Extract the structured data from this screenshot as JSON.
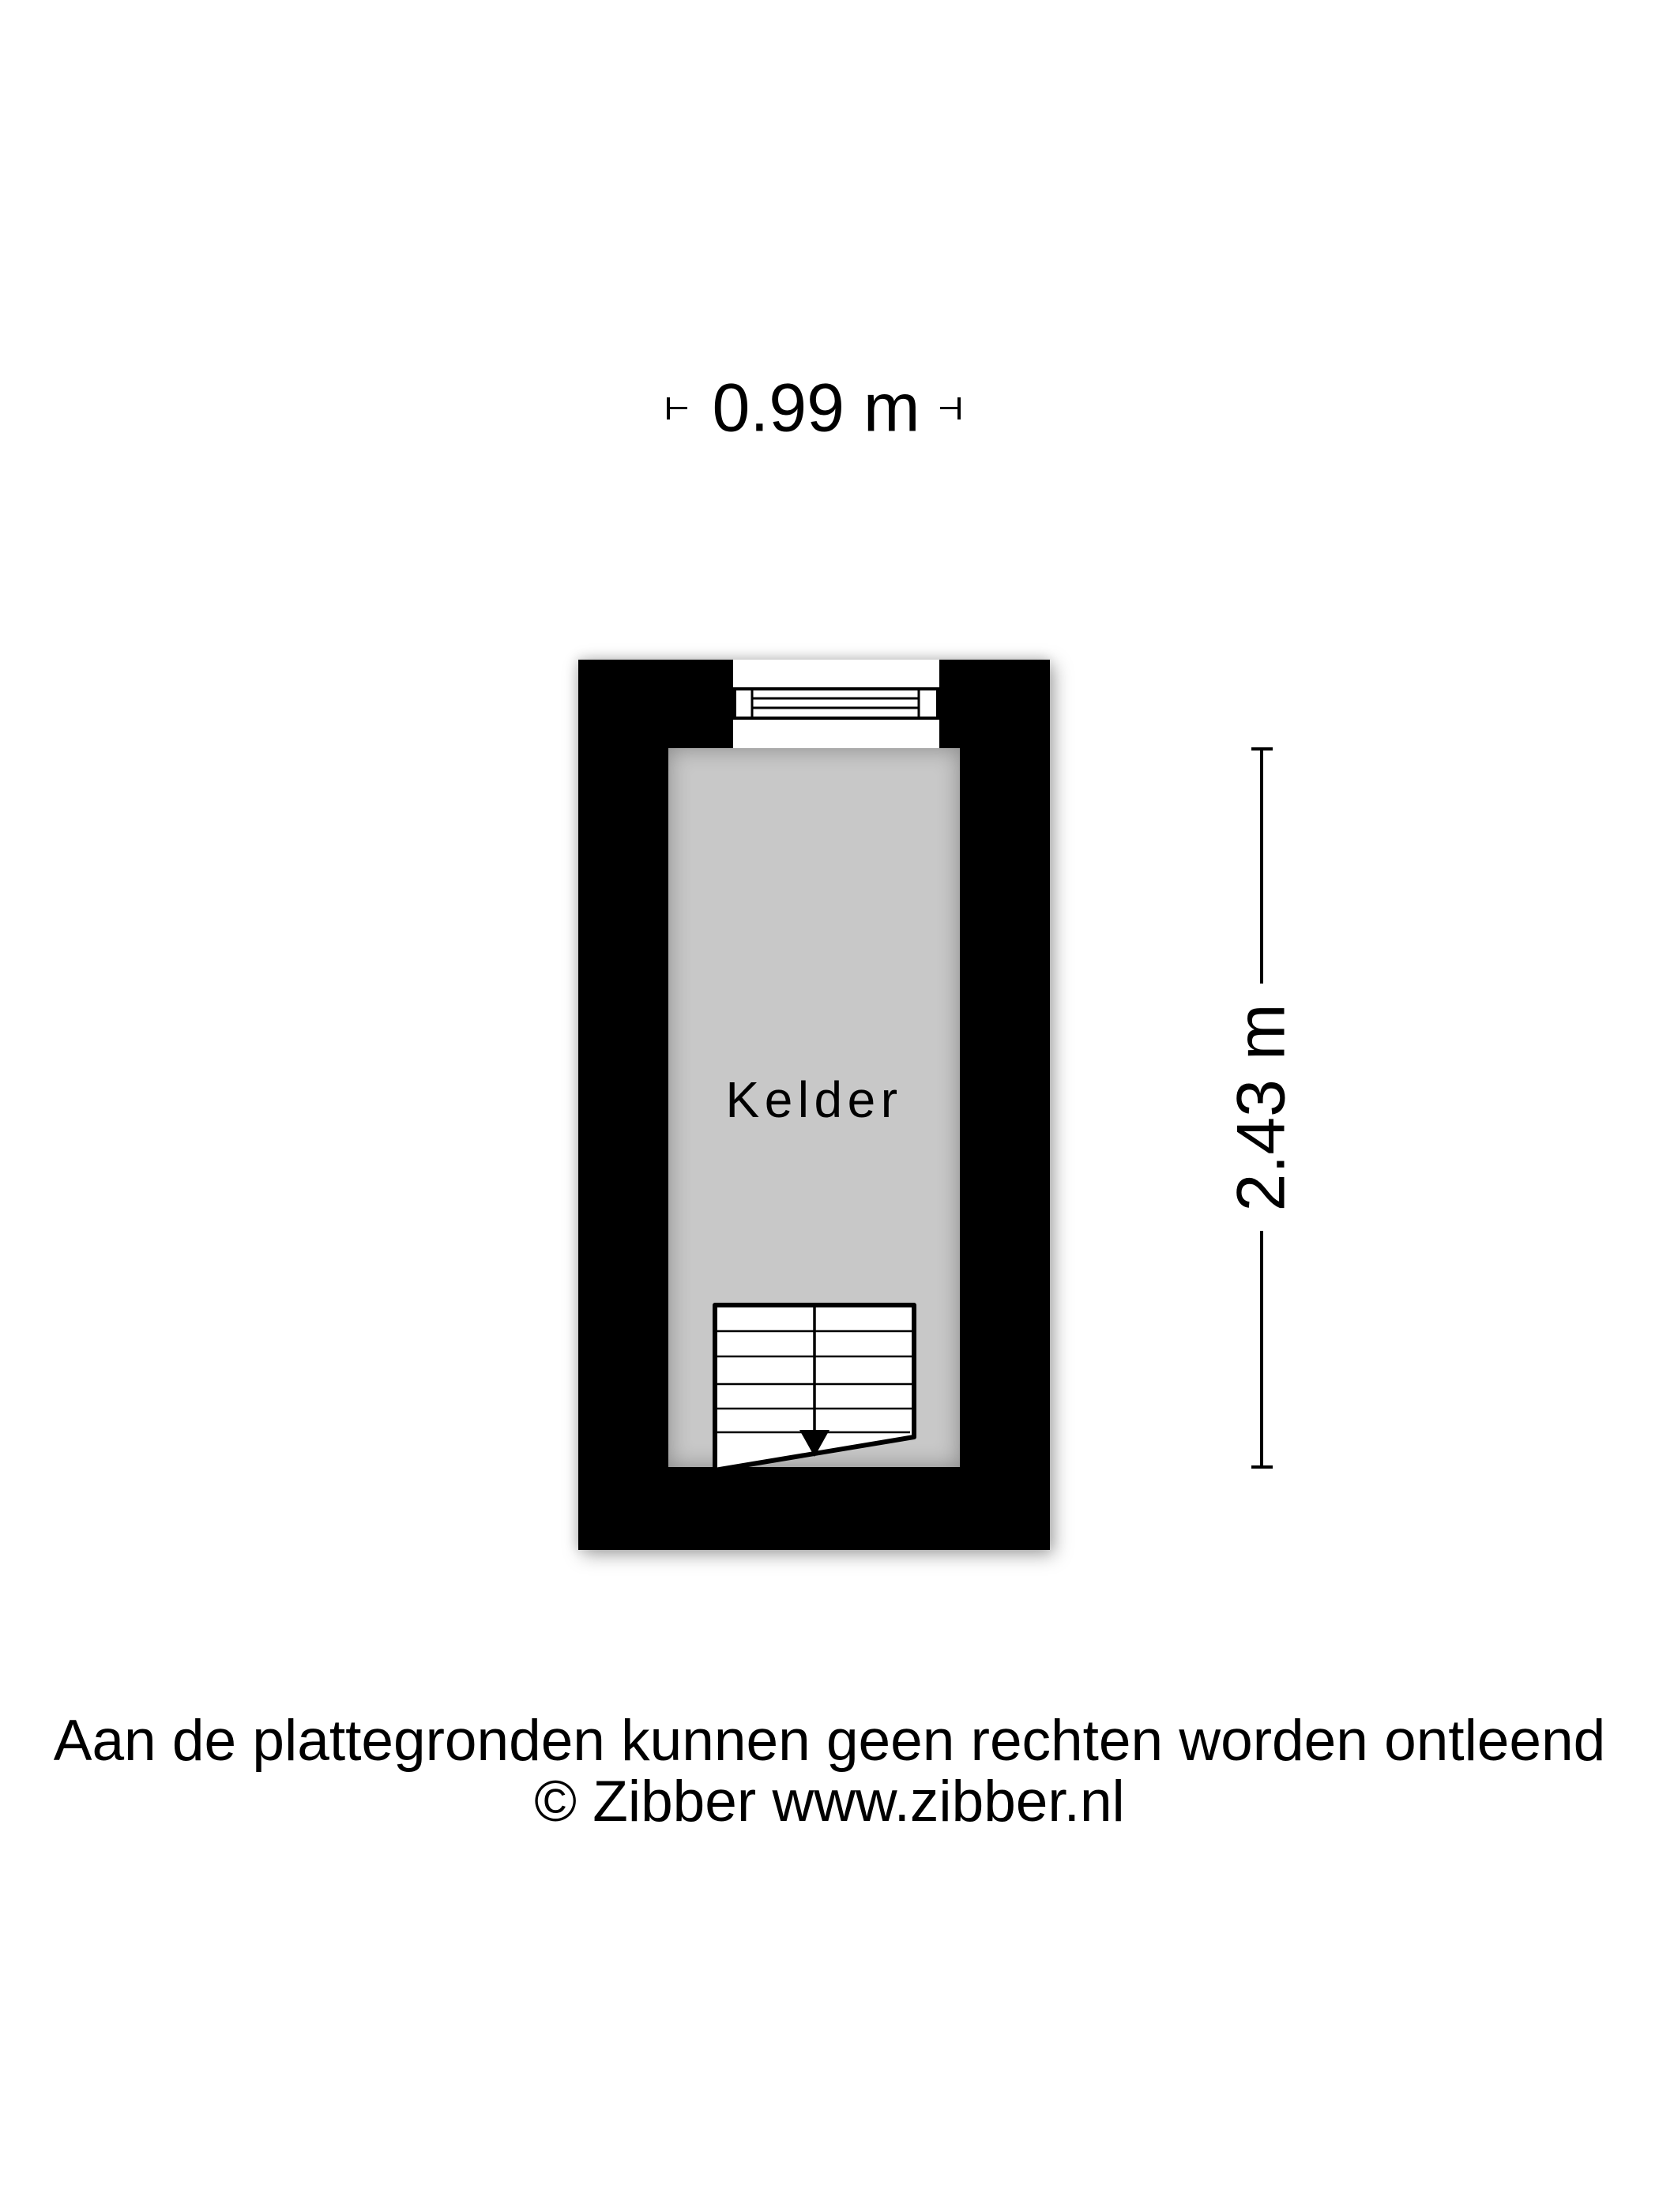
{
  "plan": {
    "room_label": "Kelder"
  },
  "dims": {
    "width_label": "0.99 m",
    "height_label": "2.43 m"
  },
  "footer": {
    "disclaimer": "Aan de plattegronden kunnen geen rechten worden ontleend",
    "copyright": "© Zibber www.zibber.nl"
  },
  "icons": {
    "window": "window-icon",
    "stairs": "stairs-icon",
    "width_ticks": [
      "dimension-tick-left-icon",
      "dimension-tick-right-icon"
    ],
    "height_caps": [
      "dimension-cap-top-icon",
      "dimension-cap-bottom-icon"
    ]
  },
  "colors": {
    "wall": "#000000",
    "room_fill": "#c8c8c8",
    "background": "#ffffff",
    "text": "#000000",
    "symbol_fill": "#ffffff"
  }
}
